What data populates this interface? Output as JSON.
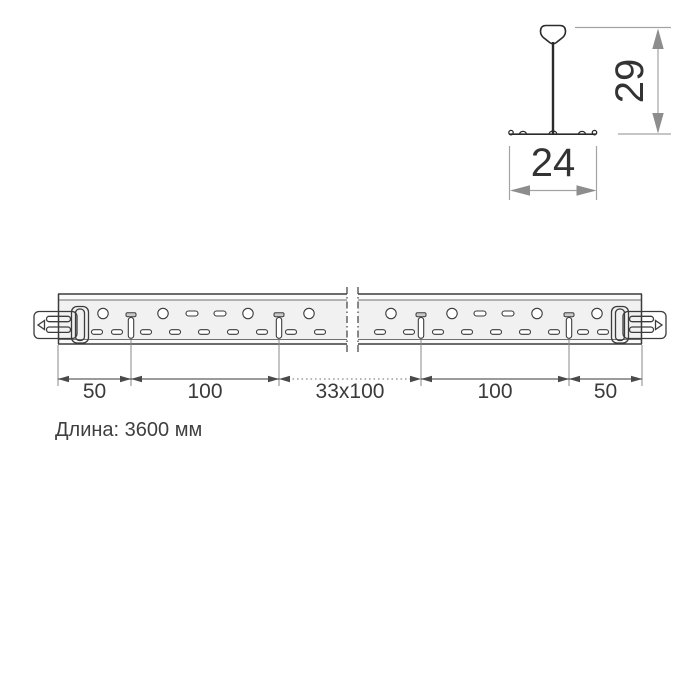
{
  "cross_section": {
    "height_value": "29",
    "width_value": "24"
  },
  "plan": {
    "dim_labels": [
      "50",
      "100",
      "33x100",
      "100",
      "50"
    ],
    "length_note": "Длина: 3600 мм"
  },
  "colors": {
    "outline": "#3c3c3c",
    "bar_fill": "#f1f1f1",
    "strip_fill": "#fafafa",
    "dim_gray_arrow": "#8d8d8d",
    "dim_dark_arrow": "#4a4a4a",
    "text": "#3a3a3a",
    "background": "#ffffff"
  },
  "geometry": {
    "bar": {
      "left": 58,
      "right": 642,
      "top": 294,
      "bottom": 344,
      "inner_top": 300,
      "inner_bottom": 339.5,
      "break_left": 347,
      "break_right": 358
    },
    "holes": {
      "circle_cy": 313.5,
      "circle_r": 5.2,
      "circles_cx": [
        103,
        163,
        248,
        309,
        391,
        452,
        537,
        597
      ],
      "upper_slots_cx": [
        192,
        220,
        480,
        508
      ],
      "upper_slot": {
        "w": 12,
        "h": 5,
        "y": 311
      },
      "lower_slots_cx": [
        97,
        117,
        146,
        175,
        204,
        233,
        262,
        291,
        320,
        380,
        409,
        438,
        467,
        496,
        525,
        554,
        583,
        603
      ],
      "lower_slot": {
        "w": 11,
        "h": 4.6,
        "y": 329.7
      },
      "vslots_cx": [
        131,
        279,
        421,
        569
      ],
      "vslot": {
        "cap_w": 10,
        "cap_h": 4,
        "cap_y": 312.7,
        "w": 5.4,
        "h": 20.8,
        "y": 317.5
      }
    },
    "dim_chain": {
      "ext_x": [
        58,
        131,
        279,
        421,
        569,
        642
      ],
      "line_y": 379,
      "ext_y1_end": 345,
      "ext_y1_mid": 340,
      "ext_y2": 386,
      "dotted_segment": [
        279,
        421
      ],
      "arrow_len": 11,
      "arrow_halfwidth": 3.3,
      "label_positions": [
        94.5,
        205,
        350,
        495,
        605.5
      ],
      "label_y": 398
    }
  }
}
